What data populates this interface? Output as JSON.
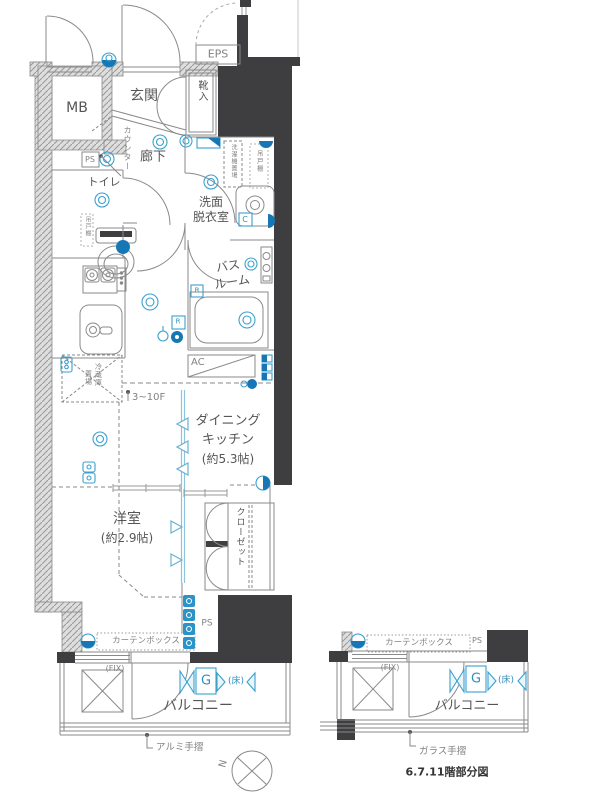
{
  "plan_type": "apartment-floor-plan",
  "colors": {
    "wall_black": "#3e3e41",
    "line_gray": "#8a8a8a",
    "text_gray": "#555555",
    "symbol_blue": "#3aa0cf",
    "symbol_blue_dark": "#1777b4",
    "hatch_bg": "#dedede"
  },
  "labels": {
    "mb": "MB",
    "entrance": "玄関",
    "shoe_box": "靴入",
    "eps": "EPS",
    "hallway": "廊下",
    "counter": "カウンター",
    "ps": "PS",
    "toilet": "トイレ",
    "hanging_cupboard": "吊戸棚",
    "washroom_line1": "洗面",
    "washroom_line2": "脱衣室",
    "washer_space": "洗濯機置場",
    "c_mark": "C",
    "bathroom_line1": "バス",
    "bathroom_line2": "ルーム",
    "r_mark": "R",
    "ac": "AC",
    "fridge_line1": "冷蔵庫",
    "fridge_line2": "置場",
    "floor_range": "3~10F",
    "dk_line1": "ダイニング",
    "dk_line2": "キッチン",
    "dk_line3": "(約5.3帖)",
    "bedroom_line1": "洋室",
    "bedroom_line2": "(約2.9帖)",
    "closet": "クローゼット",
    "curtain_box": "カーテンボックス",
    "fix": "(FIX)",
    "g_mark": "G",
    "floor_mark": "(床)",
    "balcony": "バルコニー",
    "aluminum_rail": "アルミ手摺",
    "glass_rail": "ガラス手摺",
    "partial_plan_title": "6.7.11階部分図",
    "north": "N"
  }
}
